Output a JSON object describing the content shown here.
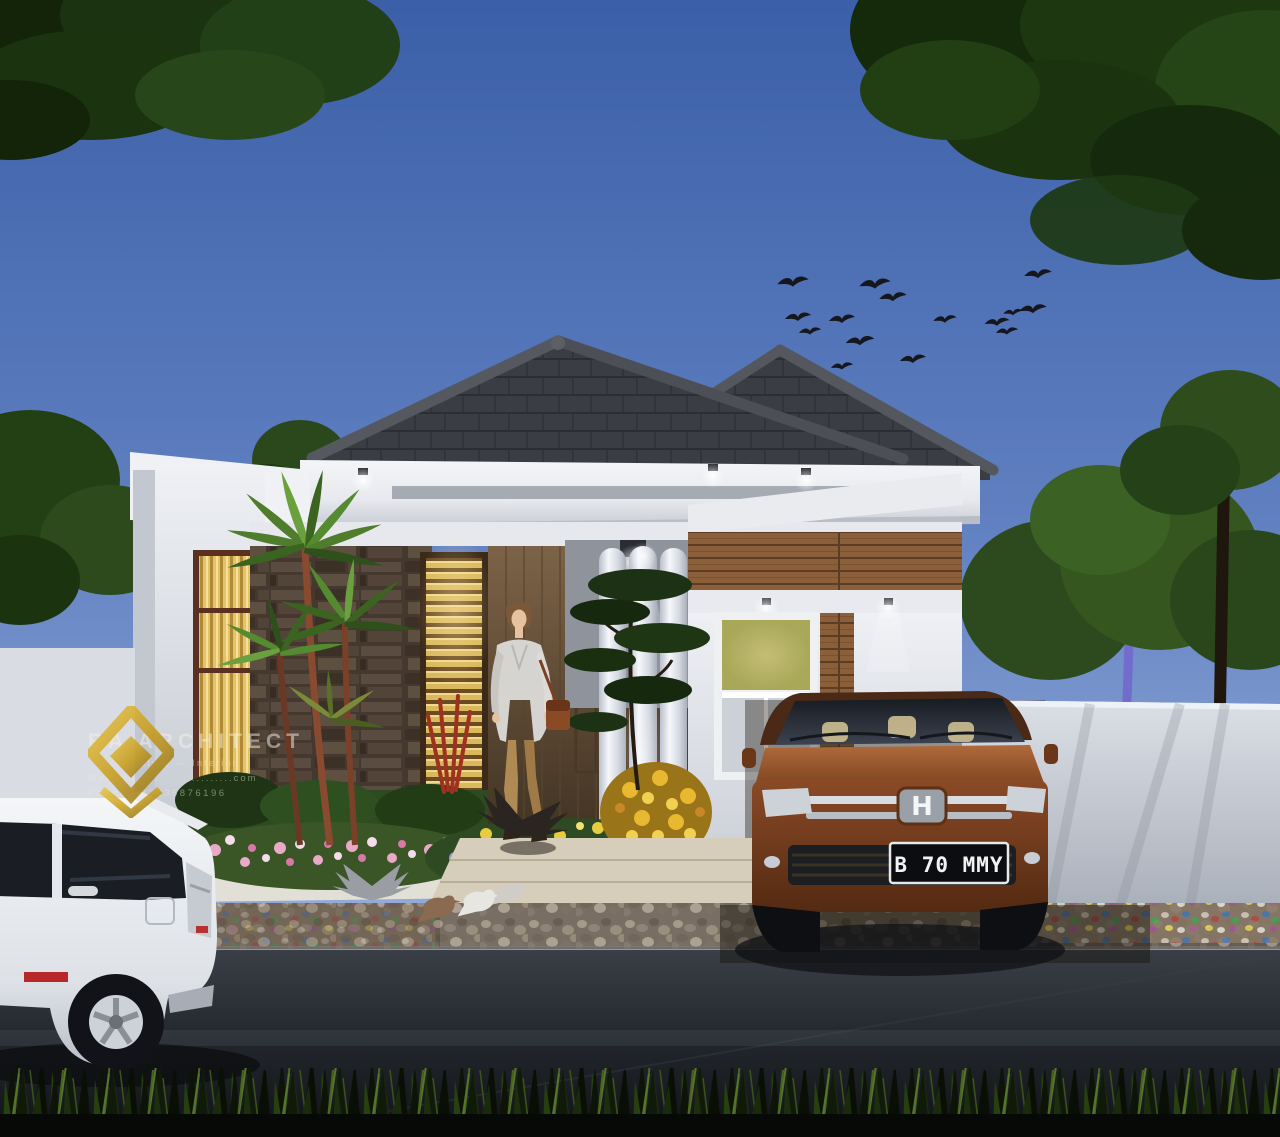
{
  "scene": {
    "type": "architectural-exterior-render",
    "subject": "Modern single-story minimalist house at dusk with carport, garden, street and parked cars",
    "palette": {
      "sky_top": "#3b5fa8",
      "sky_horizon": "#b3c6e4",
      "roof_shingle": "#3a3d43",
      "fascia_white": "#eef0f4",
      "stone_wall": "#56493d",
      "timber_wall": "#8a5f3a",
      "warm_window_light": "#e3c268",
      "column_white": "#e9ecf2",
      "suv_body_orange": "#96502c",
      "mpv_body_white": "#eff1f4",
      "foliage_dark": "#1b330f",
      "flower_pink": "#e2a8c2",
      "flower_purple": "#9a8cc8",
      "flower_yellow": "#e8c838",
      "pebble_path": "#6b6052",
      "road_asphalt": "#23272d",
      "watermark_gold": "#d2a417"
    }
  },
  "watermark": {
    "logo_icon": "gold-diamond-house",
    "brand": "RA ARCHITECT",
    "tagline": ". Architecture  —  Interior .",
    "website_line": "Website  ....................com",
    "phone_line": "Phone   082235876196"
  },
  "suv": {
    "grille_emblem": "H",
    "license_plate": "B 70 MMY"
  }
}
